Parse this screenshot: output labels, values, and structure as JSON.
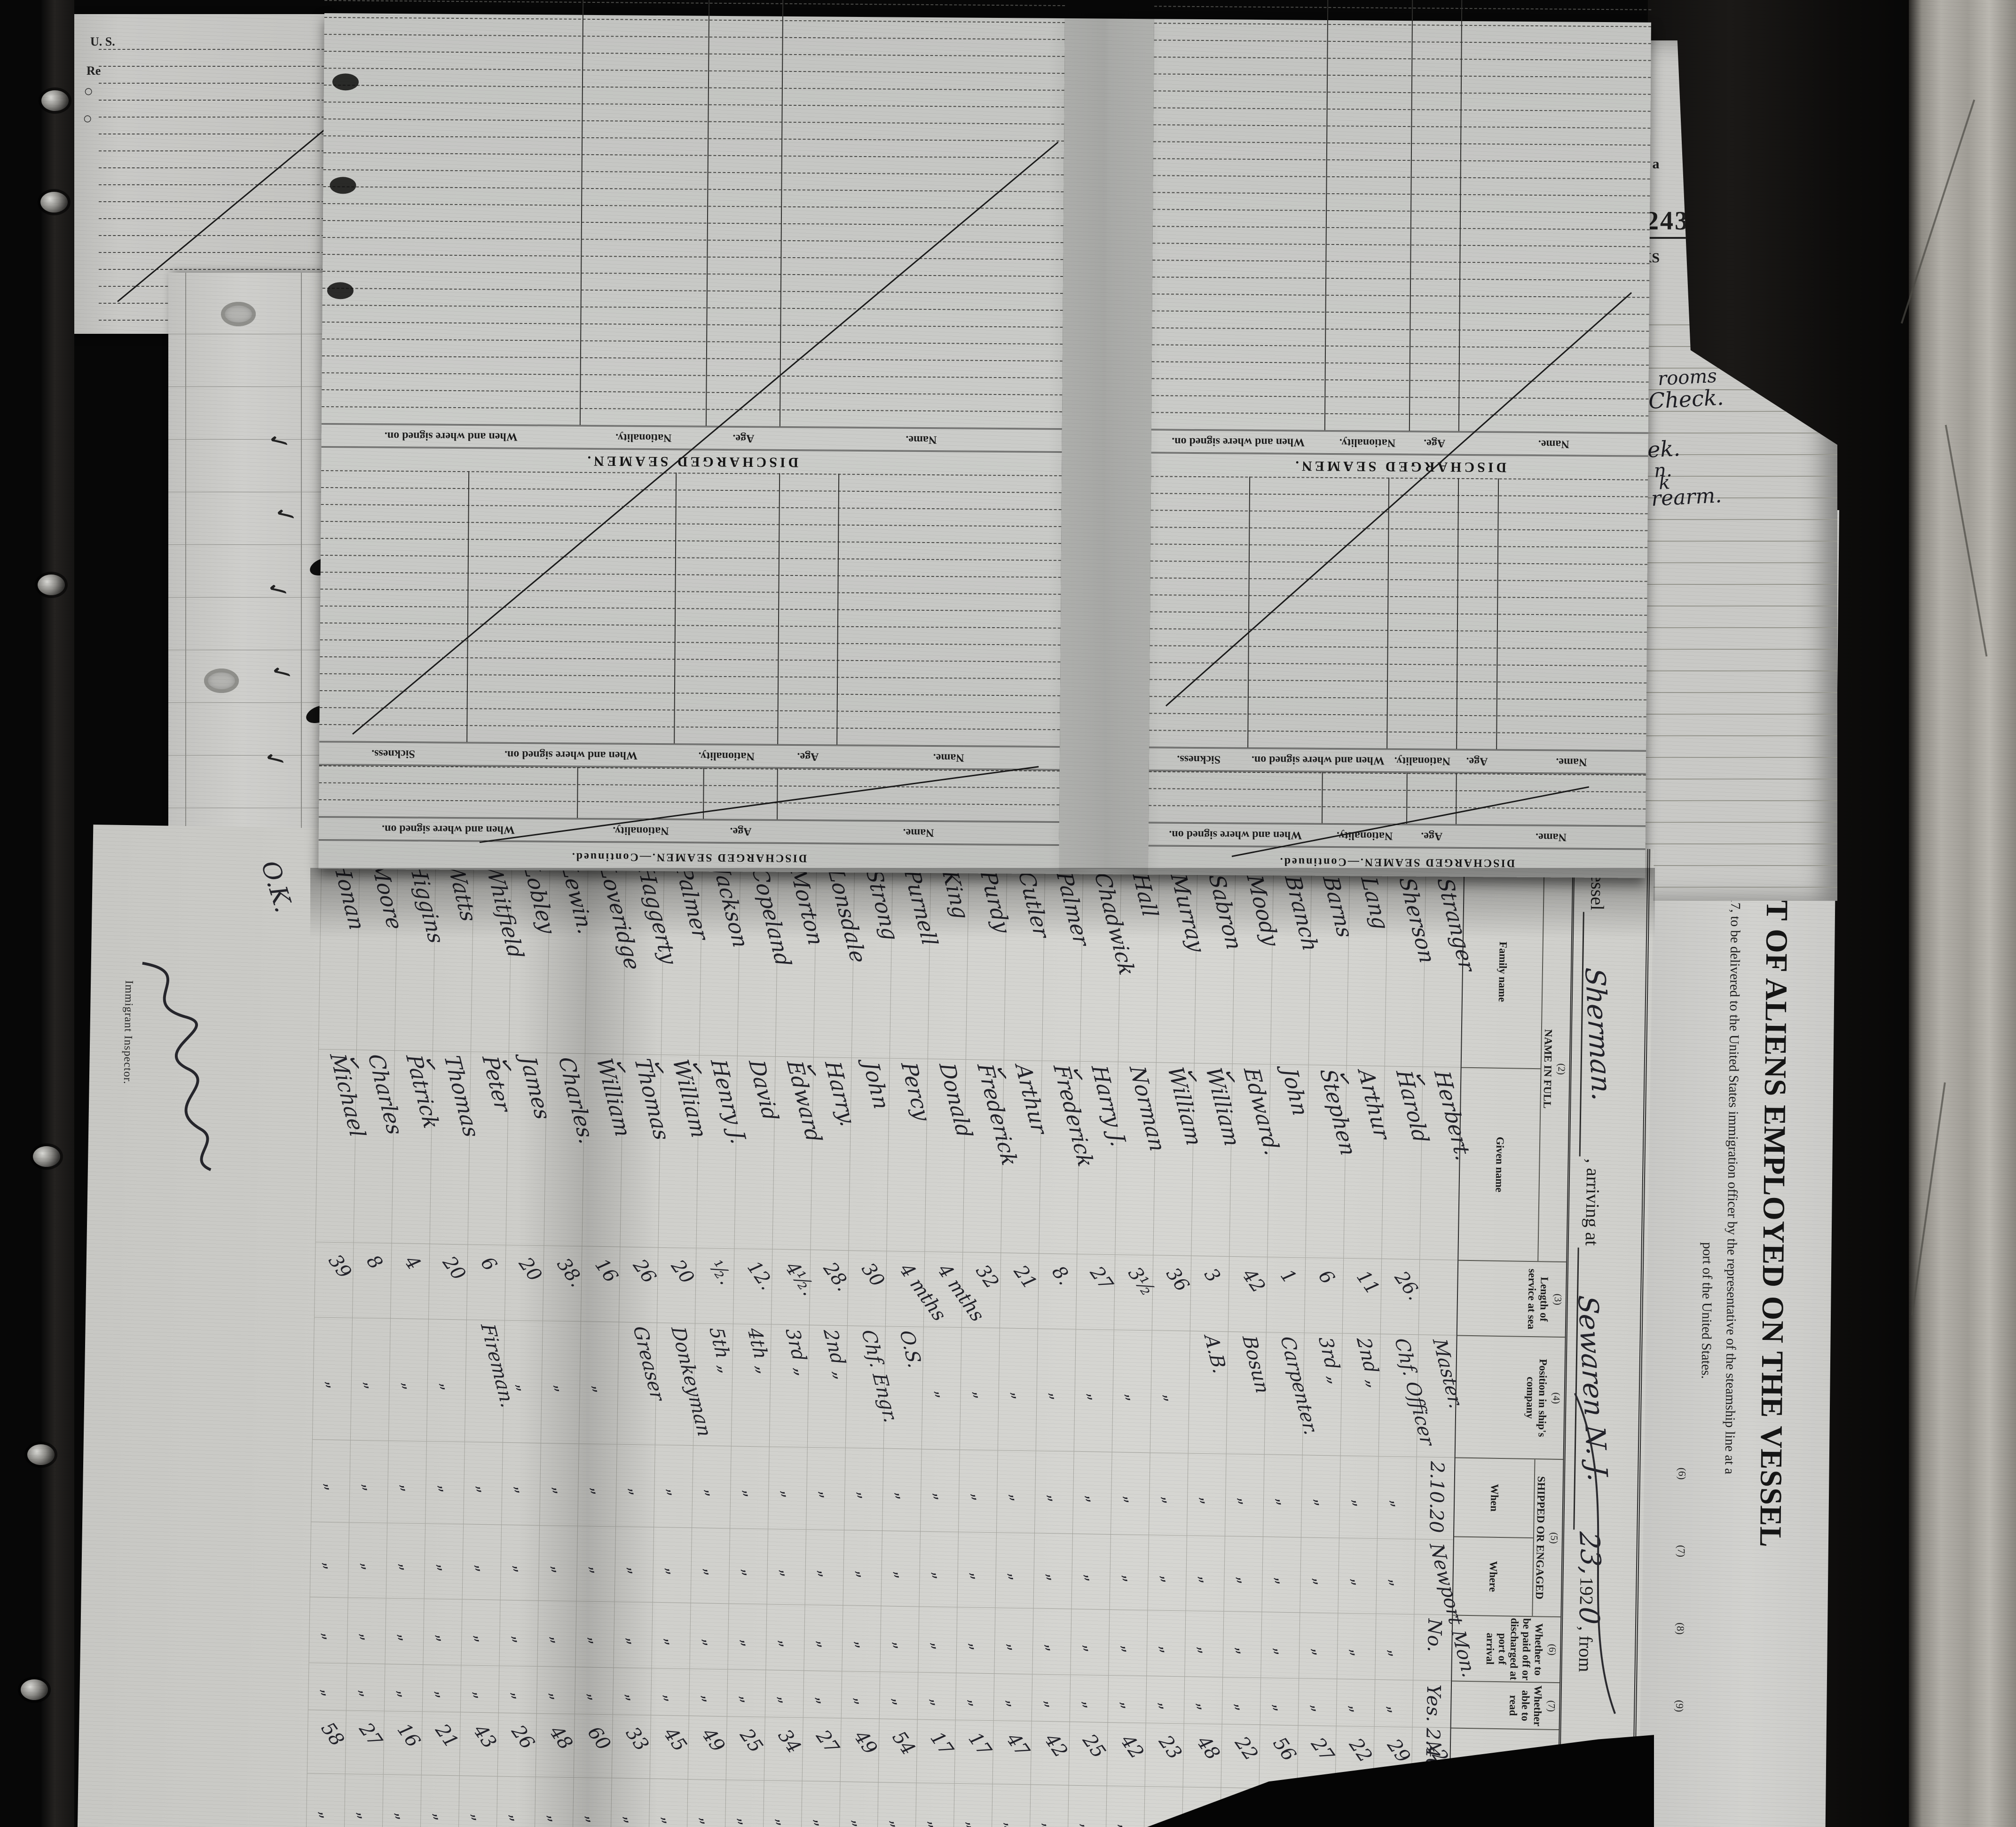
{
  "manifest": {
    "form_number_small": "14—1240",
    "vessel_label": "Vessel",
    "vessel_name": "Sherman.",
    "arriving_label": ", arriving at",
    "arrival_port": "Sewaren N. J.",
    "arrival_day": "23,",
    "year_printed": "192",
    "year_digit": "0",
    "from_label": ", from",
    "check_glyph": "✓",
    "ditto_glyph": "„",
    "ok_annotation": "O.K.",
    "inspector_label": "Immigrant Inspector.",
    "columns": {
      "c1_mark": "(1)",
      "c1": "No. on list",
      "c2_mark": "(2)",
      "c2": "NAME IN FULL",
      "c2a": "Family name",
      "c2b": "Given name",
      "c3_mark": "(3)",
      "c3": "Length of service at sea",
      "c4_mark": "(4)",
      "c4": "Position in ship's company",
      "c5_mark": "(5)",
      "c5": "SHIPPED OR ENGAGED",
      "c5a": "When",
      "c5b": "Where",
      "c6_mark": "(6)",
      "c6": "Whether to be paid off or discharged at port of arrival",
      "c7_mark": "(7)",
      "c7": "Whether able to read",
      "c8_mark": "(8)",
      "c8": "Age",
      "c9_mark": "(9)",
      "c9": "Sex"
    },
    "rows": [
      {
        "no": "1",
        "family": "Stranger",
        "given": "Herbert.",
        "check": false,
        "service": "",
        "position": "Master.",
        "when": "2.10.20",
        "where": "Newport Mon.",
        "paid": "No.",
        "read": "Yes. 2.40.",
        "age": "42",
        "sex": "M"
      },
      {
        "no": "2",
        "family": "Sherson",
        "given": "Harold",
        "check": true,
        "service": "26.",
        "position": "Chf. Officer",
        "when": "„",
        "where": "„",
        "paid": "„",
        "read": "„",
        "age": "29",
        "sex": "„"
      },
      {
        "no": "3",
        "family": "Lang",
        "given": "Arthur",
        "check": false,
        "service": "11",
        "position": "2nd  „",
        "when": "„",
        "where": "„",
        "paid": "„",
        "read": "„",
        "age": "22",
        "sex": "„"
      },
      {
        "no": "4",
        "family": "Barns",
        "given": "Stephen",
        "check": true,
        "service": "6",
        "position": "3rd  „",
        "when": "„",
        "where": "„",
        "paid": "„",
        "read": "„",
        "age": "27",
        "sex": "„"
      },
      {
        "no": "5",
        "family": "Branch",
        "given": "John",
        "check": false,
        "service": "1",
        "position": "Carpenter.",
        "when": "„",
        "where": "„",
        "paid": "„",
        "read": "„",
        "age": "56",
        "sex": "„"
      },
      {
        "no": "6",
        "family": "Moody",
        "given": "Edward.",
        "check": false,
        "service": "42",
        "position": "Bosun",
        "when": "„",
        "where": "„",
        "paid": "„",
        "read": "„",
        "age": "22",
        "sex": "„"
      },
      {
        "no": "7",
        "family": "Sabron",
        "given": "William",
        "check": true,
        "service": "3",
        "position": "A.B.",
        "when": "„",
        "where": "„",
        "paid": "„",
        "read": "„",
        "age": "48",
        "sex": "„"
      },
      {
        "no": "8",
        "family": "Murray",
        "given": "William",
        "check": true,
        "service": "36",
        "position": "„",
        "when": "„",
        "where": "„",
        "paid": "„",
        "read": "„",
        "age": "23",
        "sex": "„"
      },
      {
        "no": "9",
        "family": "Hall",
        "given": "Norman",
        "check": false,
        "service": "3½",
        "position": "„",
        "when": "„",
        "where": "„",
        "paid": "„",
        "read": "„",
        "age": "42",
        "sex": "„"
      },
      {
        "no": "10",
        "family": "Chadwick",
        "given": "Harry J.",
        "check": false,
        "service": "27",
        "position": "„",
        "when": "„",
        "where": "„",
        "paid": "„",
        "read": "„",
        "age": "25",
        "sex": "„"
      },
      {
        "no": "11",
        "family": "Palmer",
        "given": "Frederick",
        "check": true,
        "service": "8.",
        "position": "„",
        "when": "„",
        "where": "„",
        "paid": "„",
        "read": "„",
        "age": "42",
        "sex": "„"
      },
      {
        "no": "12",
        "family": "Cutler",
        "given": "Arthur",
        "check": false,
        "service": "21",
        "position": "„",
        "when": "„",
        "where": "„",
        "paid": "„",
        "read": "„",
        "age": "47",
        "sex": "„"
      },
      {
        "no": "13",
        "family": "Purdy",
        "given": "Frederick",
        "check": true,
        "service": "32",
        "position": "„",
        "when": "„",
        "where": "„",
        "paid": "„",
        "read": "„",
        "age": "17",
        "sex": "„"
      },
      {
        "no": "14",
        "family": "King",
        "given": "Donald",
        "check": false,
        "service": "4 mths",
        "position": "„",
        "when": "„",
        "where": "„",
        "paid": "„",
        "read": "„",
        "age": "17",
        "sex": "„"
      },
      {
        "no": "15",
        "family": "Purnell",
        "given": "Percy",
        "check": false,
        "service": "4 mths",
        "position": "O.S.",
        "when": "„",
        "where": "„",
        "paid": "„",
        "read": "„",
        "age": "54",
        "sex": "„"
      },
      {
        "no": "16",
        "family": "Strong",
        "given": "John",
        "check": false,
        "service": "30",
        "position": "Chf. Engr.",
        "when": "„",
        "where": "„",
        "paid": "„",
        "read": "„",
        "age": "49",
        "sex": "„"
      },
      {
        "no": "17",
        "family": "Lonsdale",
        "given": "Harry.",
        "check": false,
        "service": "28.",
        "position": "2nd  „",
        "when": "„",
        "where": "„",
        "paid": "„",
        "read": "„",
        "age": "27",
        "sex": "„"
      },
      {
        "no": "18",
        "family": "Morton",
        "given": "Edward",
        "check": true,
        "service": "4½.",
        "position": "3rd  „",
        "when": "„",
        "where": "„",
        "paid": "„",
        "read": "„",
        "age": "34",
        "sex": "„"
      },
      {
        "no": "19",
        "family": "Copeland",
        "given": "David",
        "check": false,
        "service": "12.",
        "position": "4th  „",
        "when": "„",
        "where": "„",
        "paid": "„",
        "read": "„",
        "age": "25",
        "sex": "„"
      },
      {
        "no": "20",
        "family": "Jackson",
        "given": "Henry J.",
        "check": false,
        "service": "½.",
        "position": "5th  „",
        "when": "„",
        "where": "„",
        "paid": "„",
        "read": "„",
        "age": "49",
        "sex": "„"
      },
      {
        "no": "21",
        "family": "Palmer",
        "given": "William",
        "check": true,
        "service": "20",
        "position": "Donkeyman",
        "when": "„",
        "where": "„",
        "paid": "„",
        "read": "„",
        "age": "45",
        "sex": "„"
      },
      {
        "no": "22",
        "family": "Haggerty",
        "given": "Thomas",
        "check": true,
        "service": "26",
        "position": "Greaser",
        "when": "„",
        "where": "„",
        "paid": "„",
        "read": "„",
        "age": "33",
        "sex": "„"
      },
      {
        "no": "23",
        "family": "Loveridge",
        "given": "William",
        "check": true,
        "service": "16",
        "position": "„",
        "when": "„",
        "where": "„",
        "paid": "„",
        "read": "„",
        "age": "60",
        "sex": "„"
      },
      {
        "no": "24",
        "family": "Lewin.",
        "given": "Charles.",
        "check": false,
        "service": "38.",
        "position": "„",
        "when": "„",
        "where": "„",
        "paid": "„",
        "read": "„",
        "age": "48",
        "sex": "„"
      },
      {
        "no": "25",
        "family": "Lobley",
        "given": "James",
        "check": false,
        "service": "20",
        "position": "„",
        "when": "„",
        "where": "„",
        "paid": "„",
        "read": "„",
        "age": "26",
        "sex": "„"
      },
      {
        "no": "26",
        "family": "Whitfield",
        "given": "Peter",
        "check": true,
        "service": "6",
        "position": "Fireman.",
        "when": "„",
        "where": "„",
        "paid": "„",
        "read": "„",
        "age": "43",
        "sex": "„"
      },
      {
        "no": "27",
        "family": "Watts",
        "given": "Thomas",
        "check": false,
        "service": "20",
        "position": "„",
        "when": "„",
        "where": "„",
        "paid": "„",
        "read": "„",
        "age": "21",
        "sex": "„"
      },
      {
        "no": "28",
        "family": "Higgins",
        "given": "Patrick",
        "check": true,
        "service": "4",
        "position": "„",
        "when": "„",
        "where": "„",
        "paid": "„",
        "read": "„",
        "age": "16",
        "sex": "„"
      },
      {
        "no": "29",
        "family": "Moore",
        "given": "Charles",
        "check": false,
        "service": "8",
        "position": "„",
        "when": "„",
        "where": "„",
        "paid": "„",
        "read": "„",
        "age": "27",
        "sex": "„"
      },
      {
        "no": "30",
        "family": "Honan",
        "given": "Michael",
        "check": true,
        "service": "39",
        "position": "„",
        "when": "„",
        "where": "„",
        "paid": "„",
        "read": "„",
        "age": "58",
        "sex": "„"
      }
    ]
  },
  "title_sheet": {
    "form_no": "Form 680",
    "dept": "U. S. DEPARTMENT OF LABOR",
    "service": "IMMIGRATION SERVICE",
    "title": "LIST OR MANIFEST OF ALIENS EMPLOYED ON THE VESSEL",
    "subtitle": "Required under Act of Congress of February 5, 1917, to be delivered to the United States immigration officer by the representative of the steamship line at a",
    "subtitle2": "port of the United States.",
    "markers": [
      "(6)",
      "(7)",
      "(8)",
      "(9)"
    ]
  },
  "ledger": {
    "section_title": "DISCHARGED SEAMEN.",
    "continued_title": "DISCHARGED SEAMEN.—Continued.",
    "columns_main": [
      "Name.",
      "Age.",
      "Nationality.",
      "When and where signed on."
    ],
    "columns_sickness": [
      "Name.",
      "Age.",
      "Nationality.",
      "When and where signed on.",
      "Sickness."
    ],
    "form_number": "16—1018",
    "continued_note": "[CONTINUED ON NEXT PAGE.]"
  },
  "page243": {
    "number": "243",
    "frag_at_a": "at a",
    "frag_ks": "KS",
    "handwriting": [
      "rooms",
      "Check.",
      "ek.",
      "n.",
      "k",
      "rearm."
    ]
  },
  "understrip": {
    "check_glyph": "✓",
    "agents_label": "Local Agents",
    "agents_blank": "__________________",
    "agents_signature": "Simpson Spence & Young",
    "owners_label": "Owners",
    "owners_blank": "______________",
    "line_label": "Line",
    "line_blank": "______________",
    "form_number": "14—1240"
  },
  "stack": {
    "frag1": "U. S.",
    "frag2": "Re",
    "circle_glyph": "○"
  }
}
